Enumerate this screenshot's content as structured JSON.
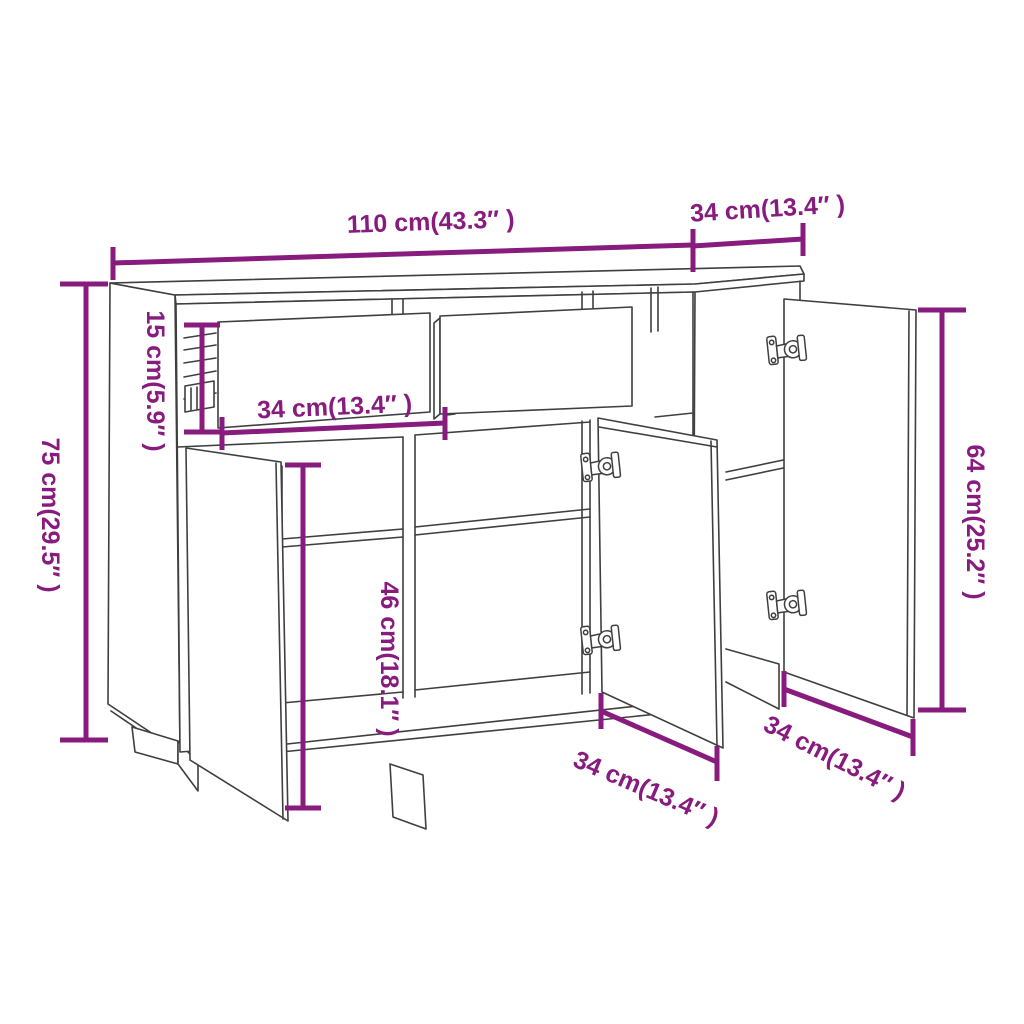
{
  "figure": {
    "type": "furniture-dimension-diagram",
    "subject": "sideboard with two pulled-out drawers and three open doors",
    "colors": {
      "dimension_accent": "#881B7E",
      "drawing_line": "#3F3F3F",
      "background": "#FFFFFF"
    },
    "labels": {
      "top_width": "110 cm(43.3″ )",
      "top_depth": "34 cm(13.4″ )",
      "overall_height": "75 cm(29.5″ )",
      "drawer_height": "15 cm(5.9″ )",
      "drawer_width": "34 cm(13.4″ )",
      "interior_height": "46 cm(18.1″ )",
      "right_door_height": "64 cm(25.2″ )",
      "middle_door_width": "34 cm(13.4″ )",
      "right_door_width": "34 cm(13.4″ )"
    }
  }
}
